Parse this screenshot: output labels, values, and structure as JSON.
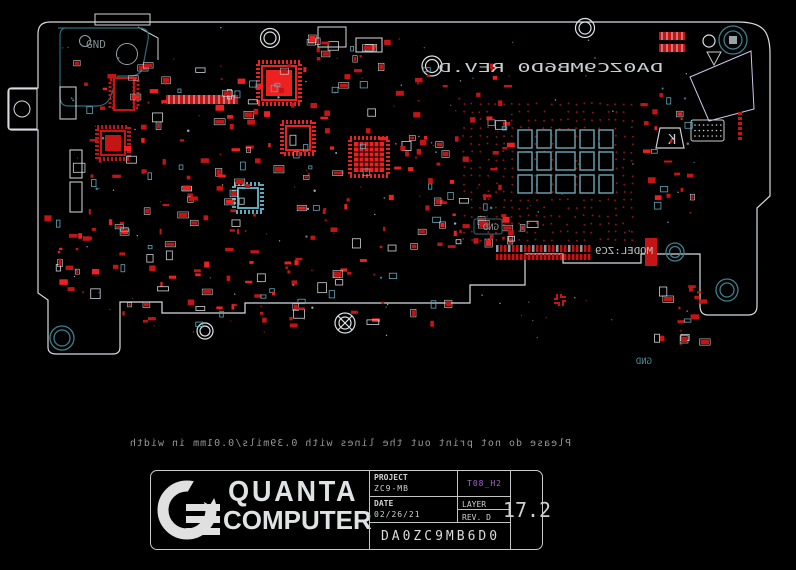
{
  "colors": {
    "background": "#000000",
    "component": "#c41414",
    "component_bright": "#ee2020",
    "component_dim": "#8c1212",
    "outline_white": "#dde2e4",
    "teal_dim": "#2f6b77",
    "teal_bright": "#5fa8b8",
    "pad_array": "#6fa6b4",
    "lavender": "#d0c4ea",
    "gray_text": "#8c9696",
    "purple": "#a565cf",
    "via_dot": "#8c1212",
    "title_text": "#d8d8d8"
  },
  "board": {
    "labels": {
      "rev_text": "DA0ZC9MB6D0  REV.D",
      "model_text": "MODEL:ZC9",
      "gnd_top_left": "GND",
      "gnd_mid": "GND",
      "gnd_right": "GND",
      "kb_marker": "K"
    }
  },
  "warning": {
    "text": "Please do not print out the lines with 0.39mils/0.01mm in width"
  },
  "title_block": {
    "logo_line1": "QUANTA",
    "logo_line2": "COMPUTER",
    "project_label": "PROJECT",
    "project_value": "ZC9-MB",
    "variant": "T08_H2",
    "date_label": "DATE",
    "date_value": "02/26/21",
    "layer_label": "LAYER",
    "rev_label": "REV. D",
    "board_number": "DA0ZC9MB6D0",
    "thickness": "17.2"
  }
}
